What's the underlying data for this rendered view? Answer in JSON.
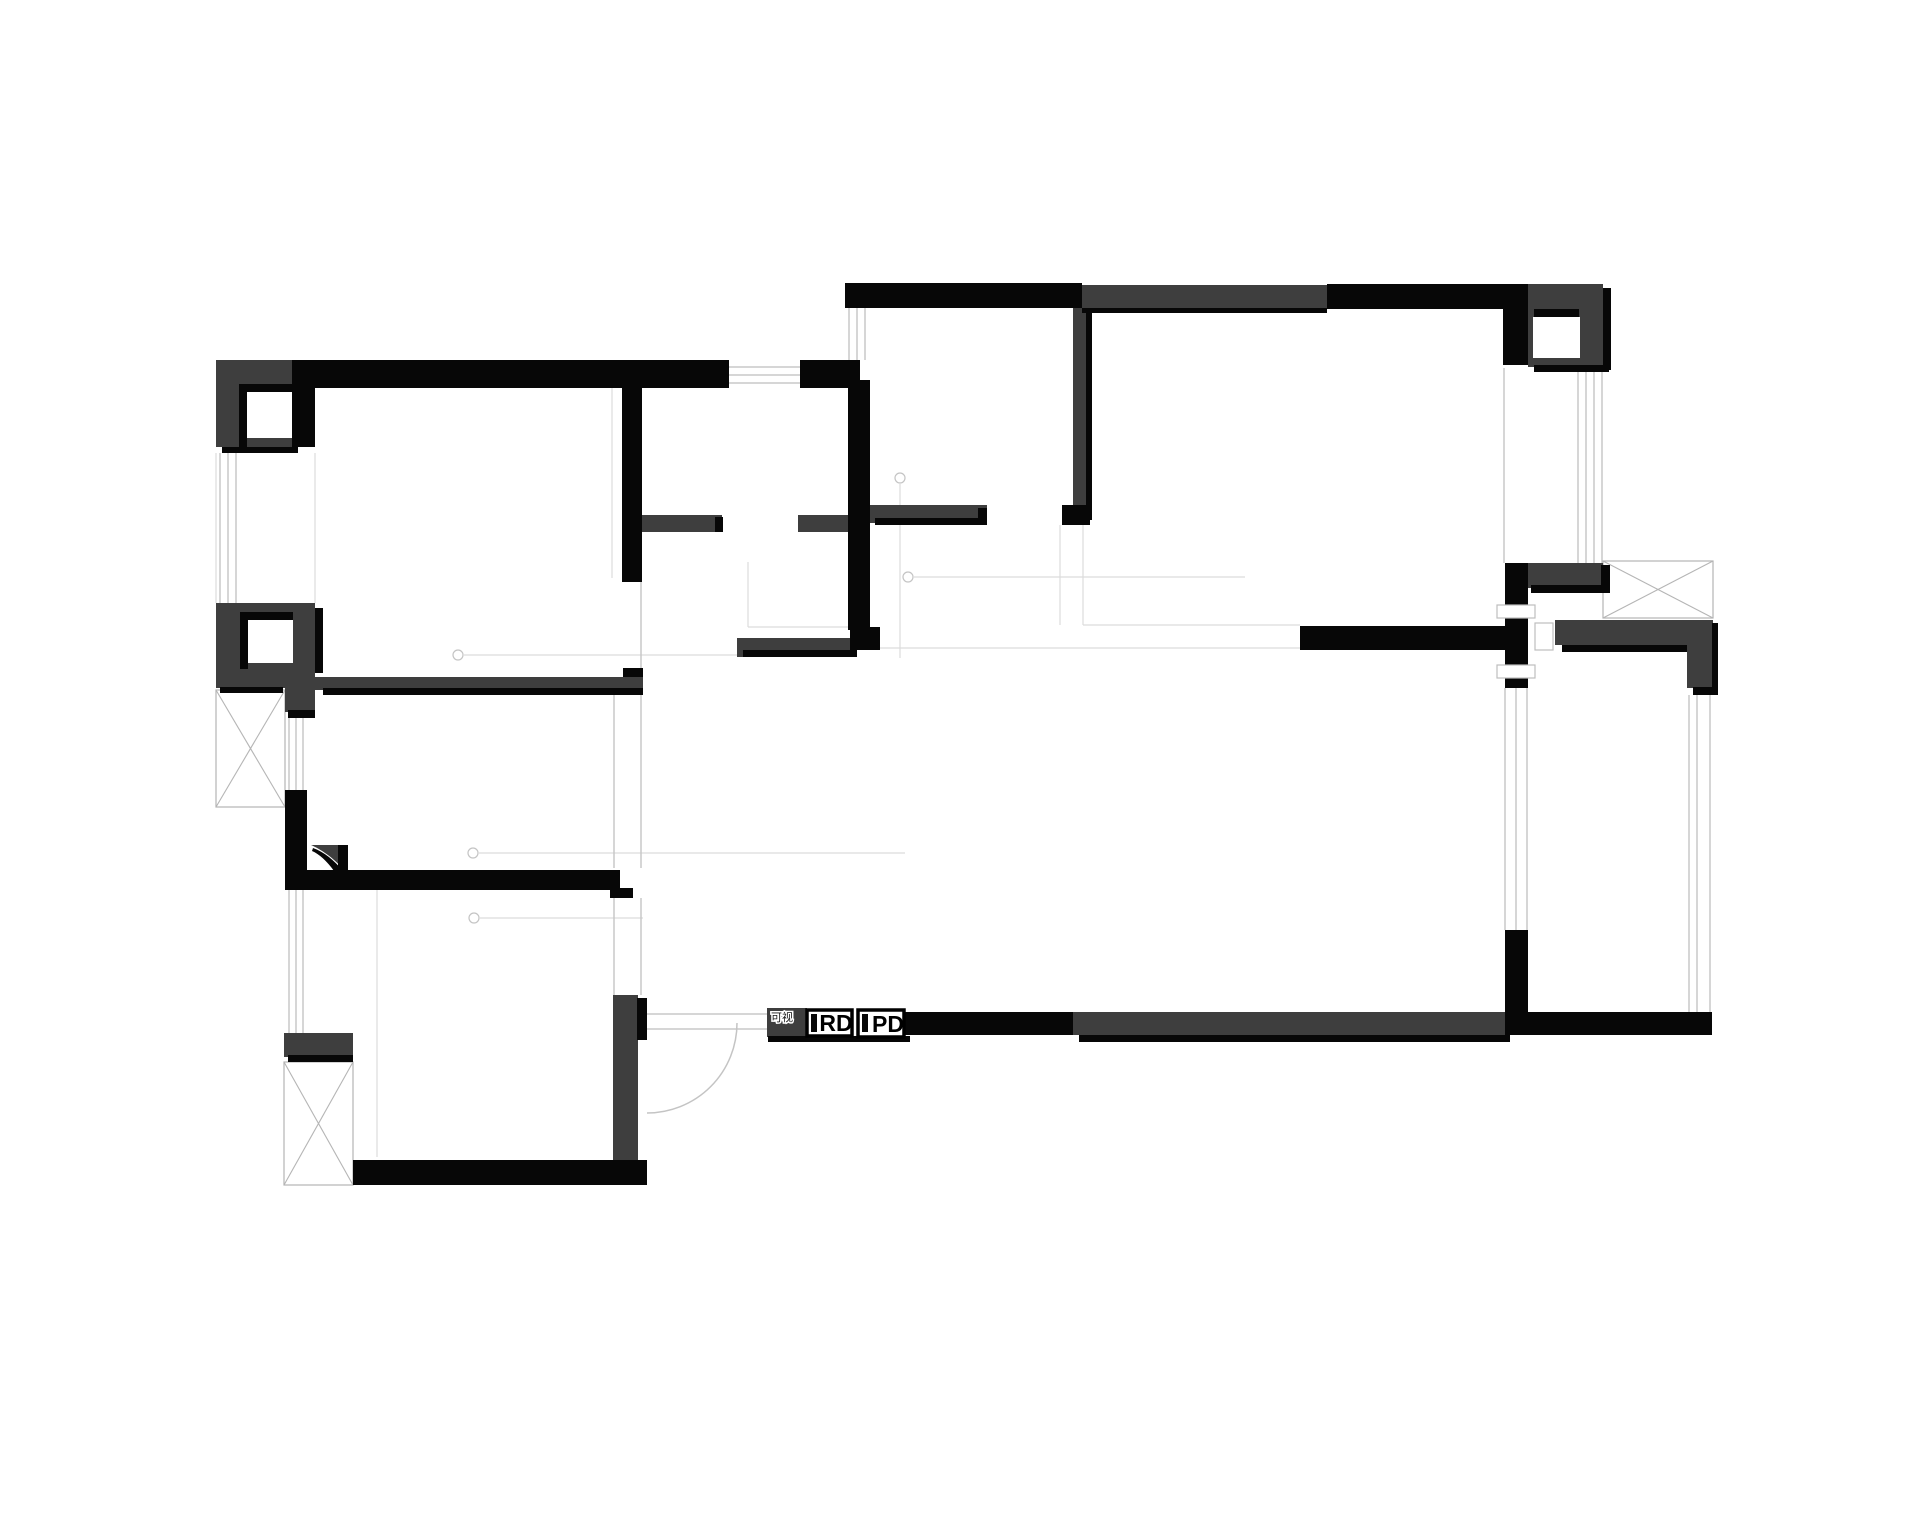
{
  "plan": {
    "type": "apartment-floor-plan",
    "labels": {
      "intercom": "可视",
      "rd": "RD",
      "pd": "PD"
    }
  },
  "colors": {
    "background": "#ffffff",
    "wallBlack": "#070707",
    "wallGray": "#3e3e3e",
    "lineLight": "#c8c8c8",
    "hatchLine": "#b5b5b5",
    "labelText": "#161616"
  }
}
